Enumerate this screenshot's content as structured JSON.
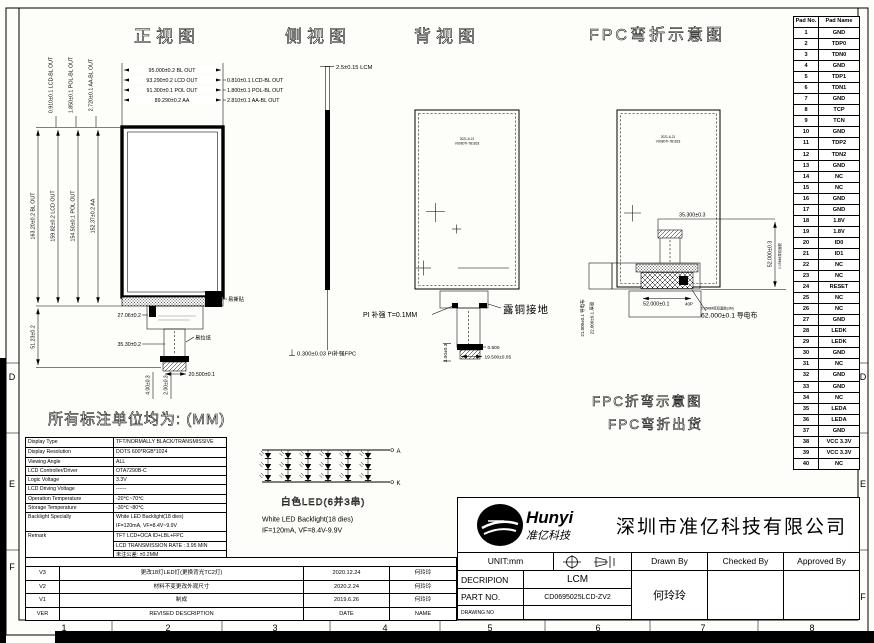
{
  "units_note": "所有标注单位均为: (MM)",
  "frame": {
    "zone_letters_left": [
      "D",
      "E",
      "F"
    ],
    "zone_letters_right": [
      "D",
      "E",
      "F"
    ],
    "zone_numbers": [
      "1",
      "2",
      "3",
      "4",
      "5",
      "6",
      "7",
      "8"
    ]
  },
  "front_view": {
    "title": "正视图",
    "top1": "95.000±0.2 BL OUT",
    "top2": "93.290±0.2 LCD OUT",
    "top3": "91.300±0.1 POL OUT",
    "top4": "89.290±0.2 AA",
    "right1": "0.810±0.1 LCD-BL OUT",
    "right2": "1.800±0.1 POL-BL OUT",
    "right3": "2.810±0.1 AA-BL OUT",
    "ltop1": "0.910±0.1 LCD-BL OUT",
    "ltop2": "1.850±0.1 POL-BL OUT",
    "ltop3": "2.720±0.1 AA-BL OUT",
    "left1": "163.20±0.2 BL OUT",
    "left2": "159.82±0.2 LCD OUT",
    "left3": "154.50±0.1 POL OUT",
    "left4": "152.37±0.2 AA",
    "left5": "51.23±0.2",
    "conn1": "27.06±0.2",
    "conn2": "35.30±0.2",
    "tear": "易撕贴",
    "pull": "易拉纸",
    "bot1": "4.00±0.3",
    "bot2": "2.00±0.3",
    "bot3": "20.500±0.1"
  },
  "side_view": {
    "title": "侧视图",
    "top": "2.5±0.15 LCM",
    "bottom": "0.300±0.03 PI补强FPC"
  },
  "back_view": {
    "title": "背视图",
    "chip1": "2021-6-21",
    "chip2": "VS080TI-7B1818",
    "pi": "PI 补强 T=0.1MM",
    "copper": "露铜接地",
    "d1": "3.00±0.3",
    "d2": "0.500",
    "d3": "19.500±0.05"
  },
  "fpc_view": {
    "title": "FPC弯折示意图",
    "chip1": "2021-6-21",
    "chip2": "VS080TI-7B1818",
    "top": "35.300±0.3",
    "right": "52.000±0.3",
    "right_note": "0.05MM厚双面胶",
    "bottom": "52.000±0.1",
    "bottom_suffix": "40P",
    "cloth": "62.000±0.1 导电布",
    "cloth_note": "0.05MM厚双面胶(3M)",
    "side1": "21.000±0.1 导电布",
    "side2": "22.000±0.1 厚胶",
    "note1": "FPC折弯示意图",
    "note2": "FPC弯折出货"
  },
  "led_circuit": {
    "caption": "白色LED(6并3串)",
    "en1": "White LED Backlight(18 dies)",
    "en2": "IF=120mA, VF=8.4V-9.9V",
    "terminal_a": "A",
    "terminal_k": "K"
  },
  "pin_table": {
    "col1": "Pad No.",
    "col2": "Pad Name",
    "rows": [
      [
        "1",
        "GND"
      ],
      [
        "2",
        "TDP0"
      ],
      [
        "3",
        "TDN0"
      ],
      [
        "4",
        "GND"
      ],
      [
        "5",
        "TDP1"
      ],
      [
        "6",
        "TDN1"
      ],
      [
        "7",
        "GND"
      ],
      [
        "8",
        "TCP"
      ],
      [
        "9",
        "TCN"
      ],
      [
        "10",
        "GND"
      ],
      [
        "11",
        "TDP2"
      ],
      [
        "12",
        "TDN2"
      ],
      [
        "13",
        "GND"
      ],
      [
        "14",
        "NC"
      ],
      [
        "15",
        "NC"
      ],
      [
        "16",
        "GND"
      ],
      [
        "17",
        "GND"
      ],
      [
        "18",
        "1.8V"
      ],
      [
        "19",
        "1.8V"
      ],
      [
        "20",
        "ID0"
      ],
      [
        "21",
        "ID1"
      ],
      [
        "22",
        "NC"
      ],
      [
        "23",
        "NC"
      ],
      [
        "24",
        "RESET"
      ],
      [
        "25",
        "NC"
      ],
      [
        "26",
        "NC"
      ],
      [
        "27",
        "GND"
      ],
      [
        "28",
        "LEDK"
      ],
      [
        "29",
        "LEDK"
      ],
      [
        "30",
        "GND"
      ],
      [
        "31",
        "NC"
      ],
      [
        "32",
        "GND"
      ],
      [
        "33",
        "GND"
      ],
      [
        "34",
        "NC"
      ],
      [
        "35",
        "LEDA"
      ],
      [
        "36",
        "LEDA"
      ],
      [
        "37",
        "GND"
      ],
      [
        "38",
        "VCC 3.3V"
      ],
      [
        "39",
        "VCC 3.3V"
      ],
      [
        "40",
        "NC"
      ]
    ]
  },
  "spec_table": {
    "rows": [
      {
        "label": "Display Type",
        "value": "TFT/NORMALLY BLACK/TRANSMISSIVE"
      },
      {
        "label": "Display Resolution",
        "value": "DOTS 600*RGB*1024"
      },
      {
        "label": "Viewing Angle",
        "value": "ALL"
      },
      {
        "label": "LCD Controller/Driver",
        "value": "OTA7290B-C"
      },
      {
        "label": "Logic Voltage",
        "value": "3.3V"
      },
      {
        "label": "LCD Driving Voltage",
        "value": "------"
      },
      {
        "label": "Operation Temperature",
        "value": "-20℃~70℃"
      },
      {
        "label": "Storage Temperature",
        "value": "-30℃~80℃"
      },
      {
        "label": "Backlight Specially",
        "l1": "White LED Backlight(18 dies)",
        "l2": "IF=120mA, VF=8.4V~9.9V"
      },
      {
        "label": "Remark",
        "l1": "TFT LCD+OCA ID+LBL+FPC",
        "l2": "LCD TRANSMISSION RATE : 3.95 MIN",
        "l3": "未注公差: ±0.2MM"
      }
    ]
  },
  "revision_table": {
    "rows": [
      {
        "ver": "V3",
        "desc": "更改18灯LED灯(更换背光TC2灯)",
        "date": "2020.12.24",
        "name": "何玲玲"
      },
      {
        "ver": "V2",
        "desc": "材料不变更改外观尺寸",
        "date": "2020.2.24",
        "name": "何玲玲"
      },
      {
        "ver": "V1",
        "desc": "制成",
        "date": "2019.6.26",
        "name": "何玲玲"
      }
    ],
    "header": {
      "ver": "VER",
      "desc": "REVISED DESCRIPTION",
      "date": "DATE",
      "name": "NAME"
    }
  },
  "title_block": {
    "logo_name": "Hunyi",
    "logo_sub": "准亿科技",
    "company": "深圳市准亿科技有限公司",
    "unit_label": "UNIT:mm",
    "decription_label": "DECRIPION",
    "decription_value": "LCM",
    "part_label": "PART NO.",
    "part_value": "CD0695025LCD-ZV2",
    "drawing_label": "DRAWING NO",
    "drawn_label": "Drawn By",
    "checked_label": "Checked By",
    "approved_label": "Approved By",
    "drawn_value": "何玲玲"
  }
}
